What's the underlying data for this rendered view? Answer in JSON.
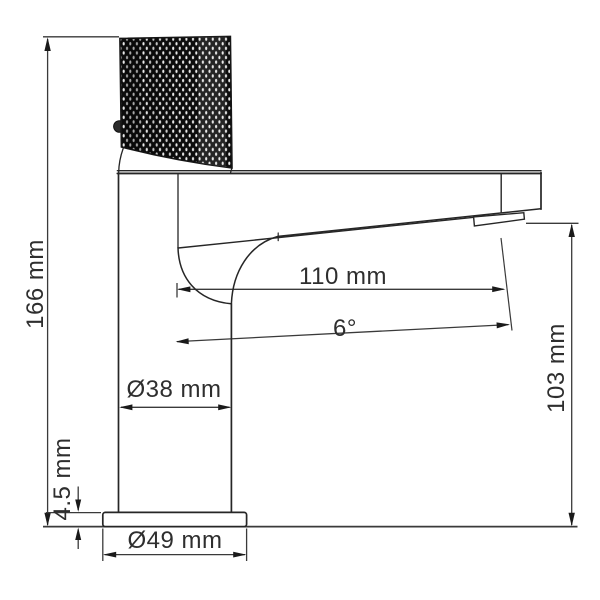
{
  "drawing": {
    "title": "Faucet dimension drawing",
    "subject": "single-lever basin mixer, side view technical outline",
    "background_color": "#ffffff",
    "line_color": "#2b2b2b",
    "text_color": "#2e2e2e",
    "handle_fill_color": "#0d0d0d"
  },
  "labels": {
    "height": "166 mm",
    "base_thickness": "4.5 mm",
    "body_diameter": "Ø38 mm",
    "base_diameter": "Ø49 mm",
    "reach": "110 mm",
    "angle": "6°",
    "spout_height": "103 mm"
  }
}
